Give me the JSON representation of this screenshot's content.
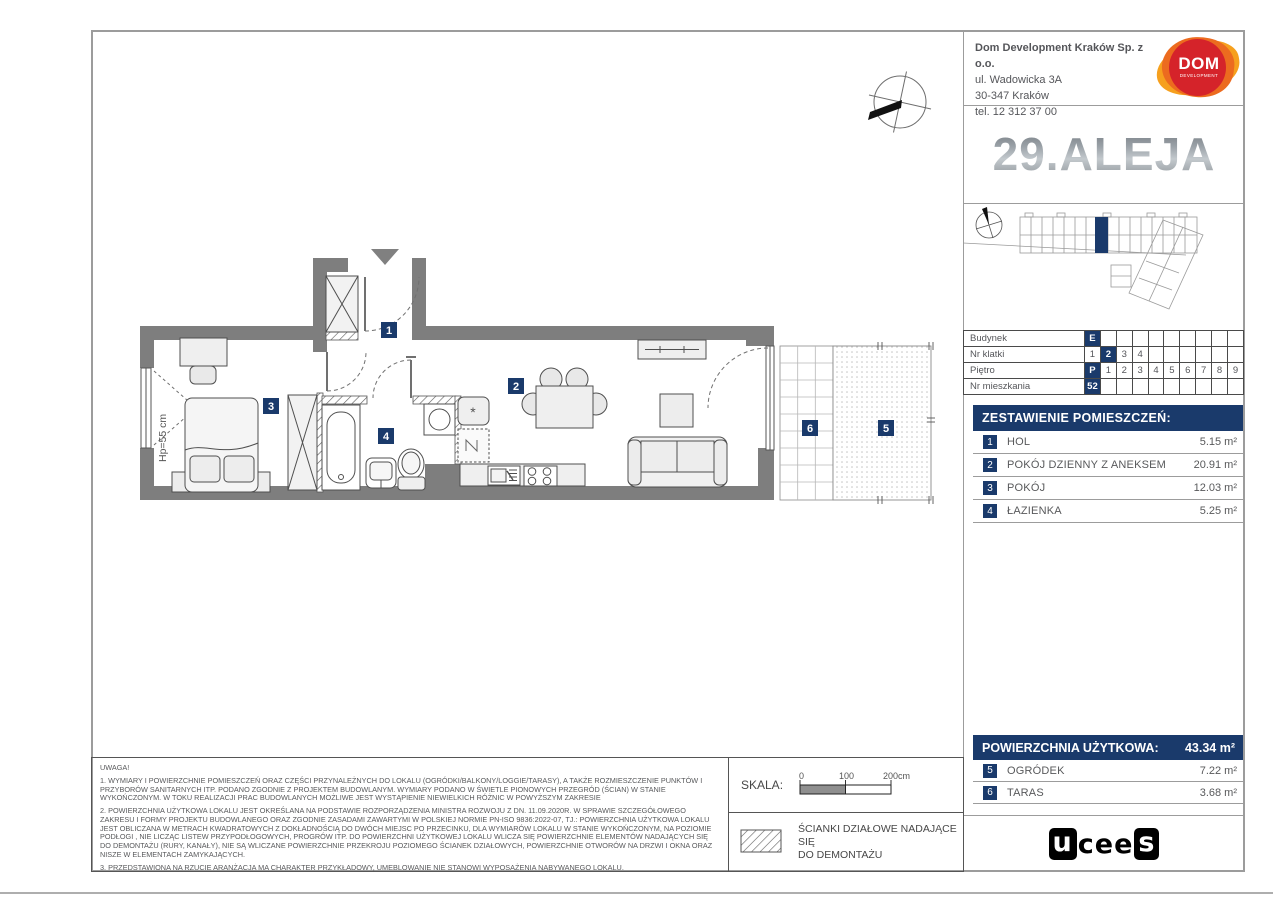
{
  "header": {
    "company": {
      "name": "Dom Development Kraków Sp. z o.o.",
      "address_line1": "ul. Wadowicka 3A",
      "address_line2": "30-347 Kraków",
      "phone": "tel. 12 312 37 00"
    },
    "dom_logo": {
      "title": "DOM",
      "subtitle": "DEVELOPMENT"
    },
    "project_logo": "29.ALEJA"
  },
  "info_table": {
    "rows": [
      {
        "label": "Budynek",
        "cells": [
          "E",
          "",
          "",
          "",
          "",
          "",
          "",
          "",
          "",
          ""
        ]
      },
      {
        "label": "Nr klatki",
        "cells": [
          "1",
          "2",
          "3",
          "4",
          "",
          "",
          "",
          "",
          "",
          ""
        ]
      },
      {
        "label": "Piętro",
        "cells": [
          "P",
          "1",
          "2",
          "3",
          "4",
          "5",
          "6",
          "7",
          "8",
          "9"
        ]
      },
      {
        "label": "Nr mieszkania",
        "cells": [
          "52",
          "",
          "",
          "",
          "",
          "",
          "",
          "",
          "",
          ""
        ]
      }
    ],
    "selected": {
      "budynek": "E",
      "nr_klatki": "2",
      "pietro": "P",
      "nr_mieszkania": "52"
    }
  },
  "rooms": {
    "header": "ZESTAWIENIE POMIESZCZEŃ:",
    "items": [
      {
        "num": "1",
        "name": "HOL",
        "area": "5.15 m²"
      },
      {
        "num": "2",
        "name": "POKÓJ DZIENNY Z ANEKSEM",
        "area": "20.91 m²"
      },
      {
        "num": "3",
        "name": "POKÓJ",
        "area": "12.03 m²"
      },
      {
        "num": "4",
        "name": "ŁAZIENKA",
        "area": "5.25 m²"
      }
    ]
  },
  "totals": {
    "label": "POWIERZCHNIA UŻYTKOWA:",
    "value": "43.34 m²",
    "extras": [
      {
        "num": "5",
        "name": "OGRÓDEK",
        "area": "7.22 m²"
      },
      {
        "num": "6",
        "name": "TARAS",
        "area": "3.68 m²"
      }
    ]
  },
  "plan": {
    "badges": [
      "1",
      "2",
      "3",
      "4",
      "5",
      "6"
    ],
    "window_sill_label": "Hp=55 cm",
    "boiler_symbol": "*"
  },
  "scale": {
    "label": "SKALA:",
    "tick0": "0",
    "tick100": "100",
    "tick200": "200cm"
  },
  "legend": {
    "line1": "ŚCIANKI DZIAŁOWE NADAJĄCE SIĘ",
    "line2": "DO DEMONTAŻU"
  },
  "notes": {
    "title": "UWAGA!",
    "p1": "1. WYMIARY I POWIERZCHNIE POMIESZCZEŃ ORAZ CZĘŚCI PRZYNALEŻNYCH DO LOKALU (OGRÓDKI/BALKONY/LOGGIE/TARASY), A TAKŻE ROZMIESZCZENIE PUNKTÓW I PRZYBORÓW SANITARNYCH ITP. PODANO ZGODNIE Z PROJEKTEM BUDOWLANYM. WYMIARY PODANO W ŚWIETLE PIONOWYCH PRZEGRÓD (ŚCIAN) W STANIE WYKOŃCZONYM. W TOKU REALIZACJI PRAC BUDOWLANYCH MOŻLIWE JEST WYSTĄPIENIE NIEWIELKICH RÓŻNIC W POWYŻSZYM ZAKRESIE",
    "p2": "2. POWIERZCHNIA UŻYTKOWA LOKALU JEST OKREŚLANA NA PODSTAWIE ROZPORZĄDZENIA MINISTRA ROZWOJU Z DN. 11.09.2020R. W SPRAWIE SZCZEGÓŁOWEGO ZAKRESU I FORMY PROJEKTU BUDOWLANEGO ORAZ ZGODNIE ZASADAMI ZAWARTYMI W POLSKIEJ NORMIE PN-ISO 9836:2022-07, TJ.: POWIERZCHNIA UŻYTKOWA LOKALU JEST OBLICZANA W METRACH KWADRATOWYCH Z DOKŁADNOŚCIĄ DO DWÓCH MIEJSC PO PRZECINKU, DLA WYMIARÓW LOKALU W STANIE WYKOŃCZONYM, NA POZIOMIE PODŁOGI , NIE LICZĄC LISTEW PRZYPODŁOGOWYCH, PROGRÓW ITP. DO POWIERZCHNI UŻYTKOWEJ LOKALU WLICZA SIĘ POWIERZCHNIE ELEMENTÓW NADAJĄCYCH SIĘ DO DEMONTAŻU (RURY, KANAŁY), NIE SĄ WLICZANE POWIERZCHNIE PRZEKROJU POZIOMEGO ŚCIANEK DZIAŁOWYCH, POWIERZCHNIE OTWORÓW NA DRZWI I OKNA ORAZ NISZE W ELEMENTACH ZAMYKAJĄCYCH.",
    "p3": "3. PRZEDSTAWIONA NA RZUCIE ARANŻACJA MA CHARAKTER PRZYKŁADOWY, UMEBLOWANIE NIE STANOWI WYPOSAŻENIA NABYWANEGO LOKALU."
  },
  "footer_logo": {
    "part1": "u",
    "part2": "cee",
    "part3": "s"
  },
  "colors": {
    "navy": "#1a3a6b",
    "wall": "#7e7e7e",
    "dom_red": "#d5232a",
    "dom_orange": "#ec6b1f",
    "dom_amber": "#f6a01e"
  }
}
